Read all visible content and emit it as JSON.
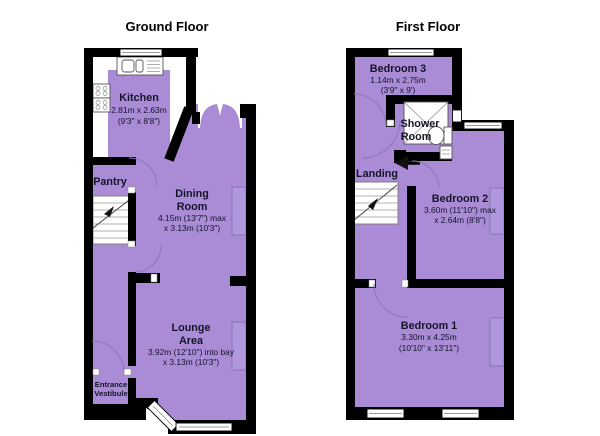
{
  "colors": {
    "room_fill": "#a98bd6",
    "furniture_fill": "#b197de",
    "wall": "#000000",
    "label": "#15152a",
    "window": "#ffffff"
  },
  "ground_floor": {
    "title": "Ground Floor",
    "kitchen": {
      "name": "Kitchen",
      "metric": "2.81m x 2.63m",
      "imperial": "(9'3\" x 8'8\")"
    },
    "pantry": {
      "name": "Pantry"
    },
    "dining_room": {
      "name_line1": "Dining",
      "name_line2": "Room",
      "dims_line1": "4.15m (13'7\") max",
      "dims_line2": "x 3.13m (10'3\")"
    },
    "lounge": {
      "name_line1": "Lounge",
      "name_line2": "Area",
      "dims_line1": "3.92m (12'10\") into bay",
      "dims_line2": "x 3.13m (10'3\")"
    },
    "entrance_vestibule": {
      "name_line1": "Entrance",
      "name_line2": "Vestibule"
    }
  },
  "first_floor": {
    "title": "First Floor",
    "bedroom3": {
      "name": "Bedroom 3",
      "metric": "1.14m x 2.75m",
      "imperial": "(3'9\" x 9')"
    },
    "shower_room": {
      "name_line1": "Shower",
      "name_line2": "Room"
    },
    "landing": {
      "name": "Landing"
    },
    "bedroom2": {
      "name": "Bedroom 2",
      "dims_line1": "3.60m (11'10\") max",
      "dims_line2": "x 2.64m (8'8\")"
    },
    "bedroom1": {
      "name": "Bedroom 1",
      "metric": "3.30m x 4.25m",
      "imperial": "(10'10\" x 13'11\")"
    }
  }
}
